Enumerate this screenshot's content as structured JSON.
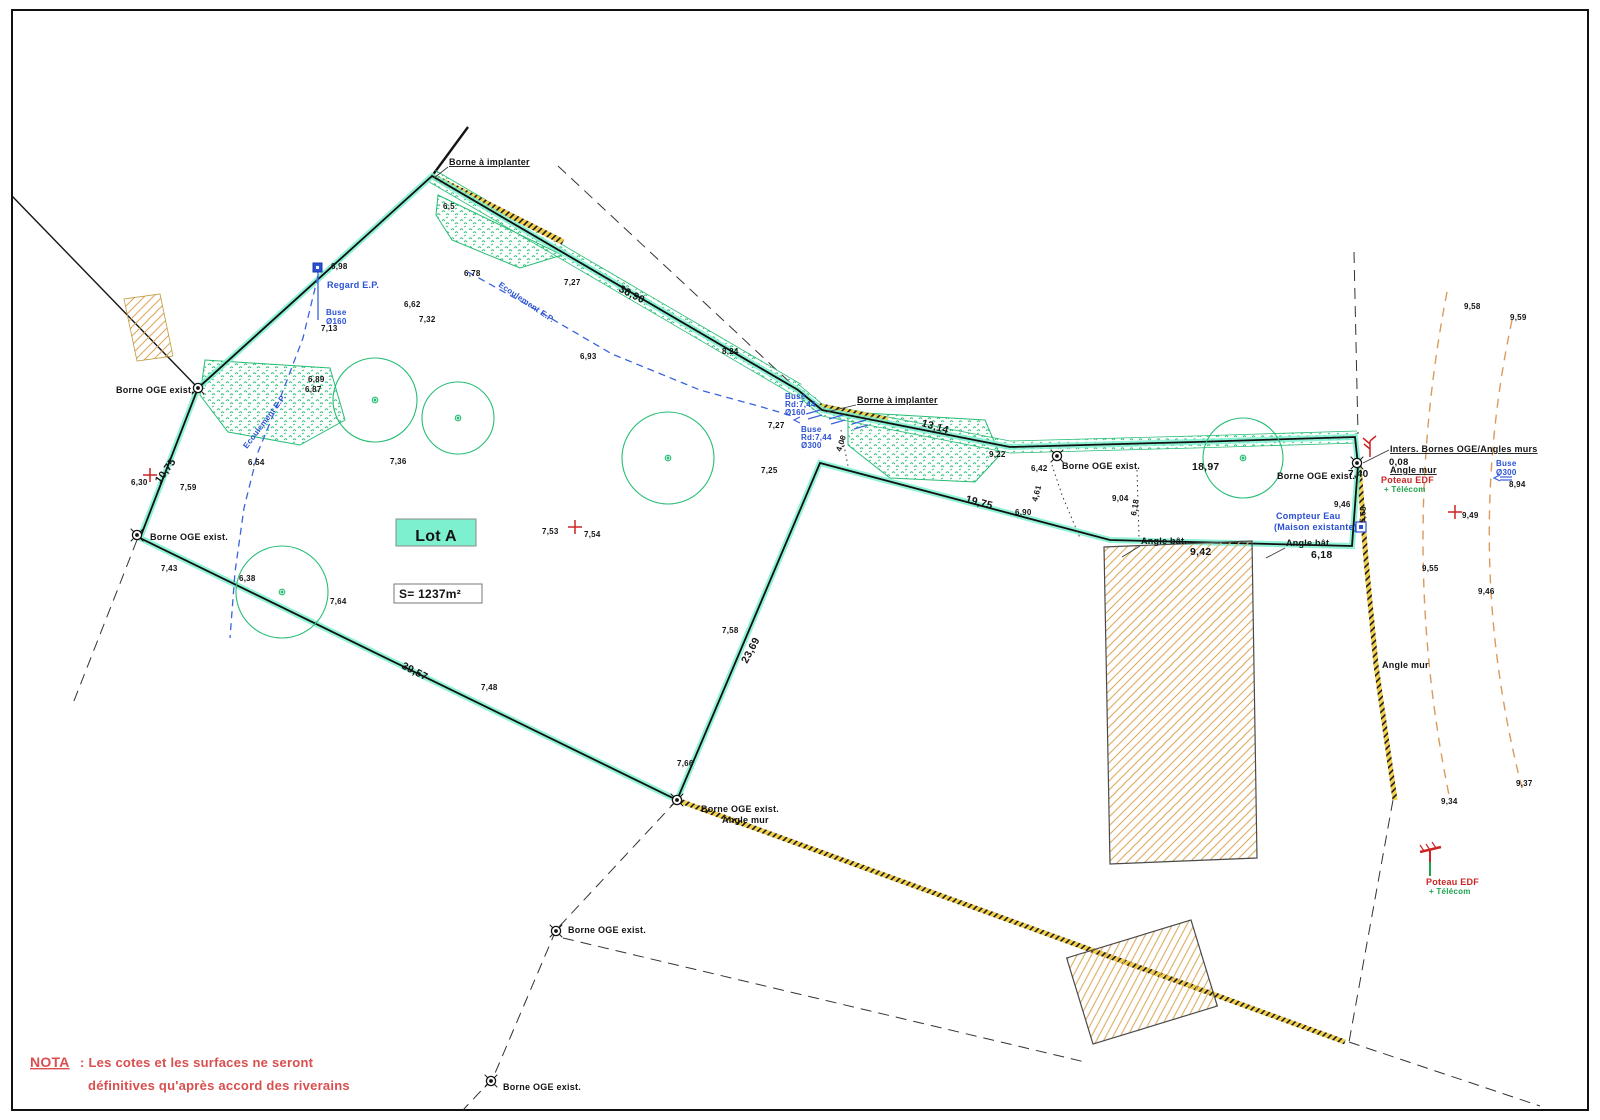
{
  "colors": {
    "text": "#141414",
    "blue": "#2a50d4",
    "red": "#cc2424",
    "green": "#1fa34d",
    "nota": "#d94f4f",
    "veg": "#27bd74",
    "teal": "#7df0cf",
    "tan": "#dcaa5e",
    "wallyellow": "#f2cf4e"
  },
  "lot": {
    "label": "Lot A",
    "surface": "S= 1237m²"
  },
  "nota": {
    "title": "NOTA",
    "line1": ": Les cotes et les surfaces ne seront",
    "line2": "définitives qu'après accord des riverains"
  },
  "annotations": [
    {
      "n": "spot-height",
      "t": "6,5",
      "x": 443,
      "y": 209
    },
    {
      "n": "spot-height",
      "t": "6,98",
      "x": 331,
      "y": 269
    },
    {
      "n": "spot-height",
      "t": "7,13",
      "x": 321,
      "y": 331
    },
    {
      "n": "spot-height",
      "t": "6,62",
      "x": 404,
      "y": 307
    },
    {
      "n": "spot-height",
      "t": "7,32",
      "x": 419,
      "y": 322
    },
    {
      "n": "spot-height",
      "t": "6,78",
      "x": 464,
      "y": 276
    },
    {
      "n": "spot-height",
      "t": "7,27",
      "x": 564,
      "y": 285
    },
    {
      "n": "spot-height",
      "t": "6,93",
      "x": 580,
      "y": 359
    },
    {
      "n": "spot-height",
      "t": "8,24",
      "x": 722,
      "y": 354
    },
    {
      "n": "spot-height",
      "t": "6,89",
      "x": 308,
      "y": 382
    },
    {
      "n": "spot-height",
      "t": "6,87",
      "x": 305,
      "y": 392
    },
    {
      "n": "spot-height",
      "t": "6,54",
      "x": 248,
      "y": 465
    },
    {
      "n": "spot-height",
      "t": "7,36",
      "x": 390,
      "y": 464
    },
    {
      "n": "spot-height",
      "t": "6,30",
      "x": 131,
      "y": 485
    },
    {
      "n": "spot-height",
      "t": "7,59",
      "x": 180,
      "y": 490
    },
    {
      "n": "spot-height",
      "t": "7,43",
      "x": 161,
      "y": 571
    },
    {
      "n": "spot-height",
      "t": "6,38",
      "x": 239,
      "y": 581
    },
    {
      "n": "spot-height",
      "t": "7,64",
      "x": 330,
      "y": 604
    },
    {
      "n": "spot-height",
      "t": "7,53",
      "x": 542,
      "y": 534
    },
    {
      "n": "spot-height",
      "t": "7,54",
      "x": 584,
      "y": 537
    },
    {
      "n": "spot-height",
      "t": "7,25",
      "x": 761,
      "y": 473
    },
    {
      "n": "spot-height",
      "t": "7,27",
      "x": 768,
      "y": 428
    },
    {
      "n": "spot-height",
      "t": "9,22",
      "x": 989,
      "y": 457
    },
    {
      "n": "spot-height",
      "t": "6,42",
      "x": 1031,
      "y": 471
    },
    {
      "n": "spot-height",
      "t": "9,04",
      "x": 1112,
      "y": 501
    },
    {
      "n": "spot-height",
      "t": "6,90",
      "x": 1015,
      "y": 515
    },
    {
      "n": "spot-height",
      "t": "9,46",
      "x": 1334,
      "y": 507
    },
    {
      "n": "spot-height",
      "t": "8,94",
      "x": 1509,
      "y": 487
    },
    {
      "n": "spot-height",
      "t": "9,49",
      "x": 1462,
      "y": 518
    },
    {
      "n": "spot-height",
      "t": "9,58",
      "x": 1464,
      "y": 309
    },
    {
      "n": "spot-height",
      "t": "9,59",
      "x": 1510,
      "y": 320
    },
    {
      "n": "spot-height",
      "t": "9,55",
      "x": 1422,
      "y": 571
    },
    {
      "n": "spot-height",
      "t": "9,46",
      "x": 1478,
      "y": 594
    },
    {
      "n": "spot-height",
      "t": "9,37",
      "x": 1516,
      "y": 786
    },
    {
      "n": "spot-height",
      "t": "9,34",
      "x": 1441,
      "y": 804
    },
    {
      "n": "spot-height",
      "t": "7,58",
      "x": 722,
      "y": 633
    },
    {
      "n": "spot-height",
      "t": "7,48",
      "x": 481,
      "y": 690
    },
    {
      "n": "spot-height",
      "t": "7,66",
      "x": 677,
      "y": 766
    },
    {
      "n": "dim-small",
      "t": "4,06",
      "x": 841,
      "y": 452,
      "r": -72
    },
    {
      "n": "dim-small",
      "t": "4,61",
      "x": 1037,
      "y": 502,
      "r": -75
    },
    {
      "n": "dim-small",
      "t": "6,18",
      "x": 1136,
      "y": 516,
      "r": -80
    },
    {
      "n": "dim-small",
      "t": "5,68",
      "x": 1365,
      "y": 523,
      "r": -87
    },
    {
      "n": "dim-boundary",
      "t": "10,75",
      "x": 160,
      "y": 484,
      "r": -54,
      "s": 10.5,
      "w": 700
    },
    {
      "n": "dim-boundary",
      "t": "36,90",
      "x": 618,
      "y": 291,
      "r": 27,
      "s": 10.5,
      "w": 700
    },
    {
      "n": "dim-boundary",
      "t": "13,14",
      "x": 921,
      "y": 426,
      "r": 16,
      "s": 10.5,
      "w": 700
    },
    {
      "n": "dim-boundary",
      "t": "18,97",
      "x": 1192,
      "y": 470,
      "s": 10.5,
      "w": 700
    },
    {
      "n": "dim-boundary",
      "t": "19,75",
      "x": 965,
      "y": 502,
      "r": 15,
      "s": 10.5,
      "w": 700
    },
    {
      "n": "dim-boundary",
      "t": "9,42",
      "x": 1190,
      "y": 555,
      "s": 10.5,
      "w": 700
    },
    {
      "n": "dim-boundary",
      "t": "6,18",
      "x": 1311,
      "y": 558,
      "s": 10.5,
      "w": 700
    },
    {
      "n": "dim-boundary",
      "t": "39,57",
      "x": 401,
      "y": 668,
      "r": 27,
      "s": 10.5,
      "w": 700
    },
    {
      "n": "dim-boundary",
      "t": "23,69",
      "x": 747,
      "y": 664,
      "r": -62,
      "s": 10.5,
      "w": 700
    },
    {
      "n": "dim-boundary",
      "t": "7,40",
      "x": 1348,
      "y": 477,
      "s": 10,
      "w": 700
    },
    {
      "n": "dim-boundary",
      "t": "0,08",
      "x": 1389,
      "y": 465,
      "s": 9.5,
      "w": 700
    },
    {
      "n": "label-borne-a-implanter",
      "t": "Borne à implanter",
      "x": 449,
      "y": 165,
      "s": 9,
      "u": 1
    },
    {
      "n": "label-borne-a-implanter",
      "t": "Borne à implanter",
      "x": 857,
      "y": 403,
      "s": 9,
      "u": 1
    },
    {
      "n": "label-borne-oge",
      "t": "Borne OGE exist.",
      "x": 116,
      "y": 393,
      "s": 9
    },
    {
      "n": "label-borne-oge",
      "t": "Borne OGE exist.",
      "x": 150,
      "y": 540,
      "s": 9
    },
    {
      "n": "label-borne-oge",
      "t": "Borne OGE exist.",
      "x": 701,
      "y": 812,
      "s": 9
    },
    {
      "n": "label-angle-mur",
      "t": "Angle mur",
      "x": 722,
      "y": 823,
      "s": 9
    },
    {
      "n": "label-borne-oge",
      "t": "Borne OGE exist.",
      "x": 568,
      "y": 933,
      "s": 9
    },
    {
      "n": "label-borne-oge",
      "t": "Borne OGE exist.",
      "x": 503,
      "y": 1090,
      "s": 9
    },
    {
      "n": "label-borne-oge",
      "t": "Borne OGE exist.",
      "x": 1062,
      "y": 469,
      "s": 9
    },
    {
      "n": "label-borne-oge",
      "t": "Borne OGE exist.",
      "x": 1277,
      "y": 479,
      "s": 9
    },
    {
      "n": "label-inters-bornes",
      "t": "Inters. Bornes OGE/Angles murs",
      "x": 1390,
      "y": 452,
      "s": 9,
      "u": 1
    },
    {
      "n": "label-angle-mur",
      "t": "Angle mur",
      "x": 1390,
      "y": 473,
      "s": 9,
      "u": 1
    },
    {
      "n": "label-angle-bat",
      "t": "Angle bât.",
      "x": 1141,
      "y": 544,
      "s": 9
    },
    {
      "n": "label-angle-bat",
      "t": "Angle bât.",
      "x": 1286,
      "y": 546,
      "s": 9
    },
    {
      "n": "label-angle-mur",
      "t": "Angle mur",
      "x": 1382,
      "y": 668,
      "s": 9
    },
    {
      "n": "lot-name",
      "t": "Lot A",
      "x": 436,
      "y": 541,
      "s": 16,
      "a": "middle",
      "w": 600
    },
    {
      "n": "lot-surface",
      "t": "S= 1237m²",
      "x": 399,
      "y": 598,
      "s": 12,
      "w": 600
    },
    {
      "n": "label-regard-ep",
      "t": "Regard E.P.",
      "x": 327,
      "y": 288,
      "s": 9,
      "c": "blue",
      "w": 700
    },
    {
      "n": "label-buse",
      "t": "Buse",
      "x": 326,
      "y": 315,
      "s": 8,
      "c": "blue",
      "w": 700
    },
    {
      "n": "label-buse",
      "t": "Ø160",
      "x": 326,
      "y": 324,
      "s": 8,
      "c": "blue",
      "w": 700
    },
    {
      "n": "label-buse",
      "t": "Buse",
      "x": 785,
      "y": 399,
      "s": 8,
      "c": "blue",
      "w": 700
    },
    {
      "n": "label-buse",
      "t": "Rd:7,44",
      "x": 785,
      "y": 407,
      "s": 8,
      "c": "blue",
      "w": 700
    },
    {
      "n": "label-buse",
      "t": "Ø160",
      "x": 785,
      "y": 415,
      "s": 8,
      "c": "blue",
      "w": 700
    },
    {
      "n": "label-buse",
      "t": "Buse",
      "x": 801,
      "y": 432,
      "s": 8,
      "c": "blue",
      "w": 700
    },
    {
      "n": "label-buse",
      "t": "Rd:7,44",
      "x": 801,
      "y": 440,
      "s": 8,
      "c": "blue",
      "w": 700
    },
    {
      "n": "label-buse",
      "t": "Ø300",
      "x": 801,
      "y": 448,
      "s": 8,
      "c": "blue",
      "w": 700
    },
    {
      "n": "label-ecoulement",
      "t": "Ecoulement E.P.",
      "x": 247,
      "y": 449,
      "s": 8,
      "c": "blue",
      "r": -53
    },
    {
      "n": "label-ecoulement",
      "t": "Ecoulement E.P.",
      "x": 498,
      "y": 286,
      "s": 8,
      "c": "blue",
      "r": 34
    },
    {
      "n": "label-compteur-eau",
      "t": "Compteur Eau",
      "x": 1276,
      "y": 519,
      "s": 9,
      "c": "blue",
      "w": 700
    },
    {
      "n": "label-compteur-eau",
      "t": "(Maison existante)",
      "x": 1274,
      "y": 530,
      "s": 9,
      "c": "blue",
      "w": 700
    },
    {
      "n": "label-buse",
      "t": "Buse",
      "x": 1496,
      "y": 466,
      "s": 8,
      "c": "blue",
      "w": 700
    },
    {
      "n": "label-buse",
      "t": "Ø300",
      "x": 1496,
      "y": 475,
      "s": 8,
      "c": "blue",
      "w": 700
    },
    {
      "n": "label-poteau-edf",
      "t": "Poteau EDF",
      "x": 1381,
      "y": 483,
      "s": 9,
      "c": "red",
      "w": 700
    },
    {
      "n": "label-telecom",
      "t": "+ Télécom",
      "x": 1384,
      "y": 492,
      "s": 8,
      "c": "green"
    },
    {
      "n": "label-poteau-edf",
      "t": "Poteau EDF",
      "x": 1426,
      "y": 885,
      "s": 9,
      "c": "red",
      "w": 700
    },
    {
      "n": "label-telecom",
      "t": "+ Télécom",
      "x": 1429,
      "y": 894,
      "s": 8,
      "c": "green"
    },
    {
      "n": "nota-title",
      "t": "NOTA",
      "x": 30,
      "y": 1067,
      "s": 14,
      "c": "nota",
      "w": 700,
      "u": 1
    },
    {
      "n": "nota-line1",
      "t": ": Les cotes et les surfaces ne seront",
      "x": 80,
      "y": 1067,
      "s": 13,
      "c": "nota"
    },
    {
      "n": "nota-line2",
      "t": "définitives qu'après accord des riverains",
      "x": 88,
      "y": 1090,
      "s": 13,
      "c": "nota"
    }
  ]
}
